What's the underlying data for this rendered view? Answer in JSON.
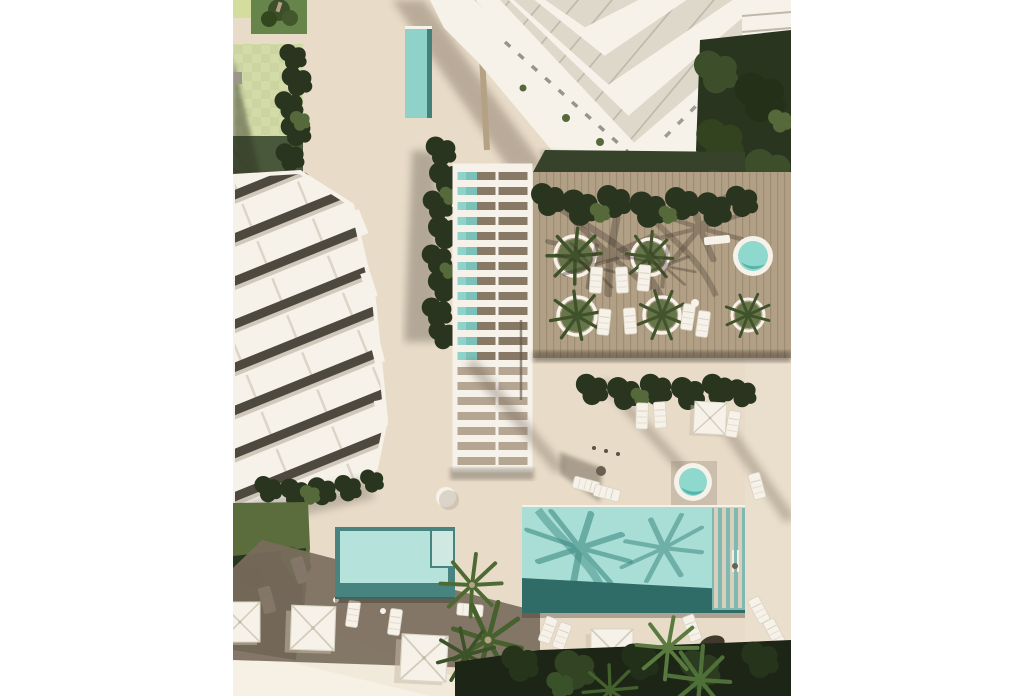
{
  "meta": {
    "title": "Aerial top-down 3D architectural rendering of a residential resort complex with pools, timber sun deck, pergola walkway, lawns and palm trees",
    "image_type": "photorealistic render, plan view, white page margins left and right",
    "background": "#ffffff"
  },
  "palette": {
    "pavement": "#e8dcc9",
    "pavementLight": "#f1e9da",
    "pavementLighter": "#f6f0e5",
    "shadowBand": "#7a6c5d",
    "wood": "#b1a086",
    "woodLine": "#9e8d73",
    "white": "#f6f2ea",
    "glass": "#ded8cb",
    "glassLine": "#bfb8aa",
    "slot": "#4d493f",
    "poolLight": "#a9ded6",
    "poolMid": "#8fd2c9",
    "poolDark": "#2f6b67",
    "poolBorder": "#478480",
    "poolSteps": "#7fb9b2",
    "stepStripe": "#d9cfbd",
    "jacuzzi": "#8fd8cd",
    "jacuzziDeep": "#57b3a8",
    "lawnDark": "#36422a",
    "lawnLit": "#5b6d3c",
    "lawnBright": "#67854a",
    "grassShade": "#49573a",
    "hedgeDark": "#2a3520",
    "hedgeDeep": "#1d2616",
    "treeGreen": "#3c4f2a",
    "leafMid": "#55693a",
    "leafLight": "#6f8c4a",
    "court": "#ccd5a1",
    "courtAlt": "#d7dfae",
    "courtYellow": "#d5dd9e",
    "trunk": "#b5a184"
  },
  "scene": {
    "buildings": [
      {
        "name": "terraced-apartment-building-left",
        "style": "white stepped terraces with dark window slots, diagonal orientation"
      },
      {
        "name": "stepped-tower-top",
        "style": "white tower with V-shaped cascading balconies and glass roof panes"
      },
      {
        "name": "wing-top-right",
        "style": "white roof wing at top right corner"
      }
    ],
    "pools": [
      {
        "name": "main-pool",
        "shape": "rectangle",
        "water": "light teal with palm shadows, dark deep end and step bench"
      },
      {
        "name": "kids-pool",
        "shape": "rectangle",
        "water": "light teal with wide dark border and step notch"
      },
      {
        "name": "pergola-lap-pool",
        "shape": "narrow strip under slatted pergola"
      },
      {
        "name": "tower-lap-pool",
        "shape": "narrow strip beside tower"
      },
      {
        "name": "round-spa-upper",
        "shape": "circle"
      },
      {
        "name": "round-spa-lower",
        "shape": "circle"
      }
    ],
    "amenities": [
      "timber-sun-deck",
      "slatted-pergola-walkway",
      "round-planters-with-palms",
      "sun-loungers",
      "square-parasols",
      "lawns-and-hedges",
      "palm-trees",
      "checkered-green-court"
    ],
    "counts": {
      "square_parasols": 5,
      "round_planters": 5,
      "round_spas": 2,
      "rectangular_pools": 4
    }
  }
}
